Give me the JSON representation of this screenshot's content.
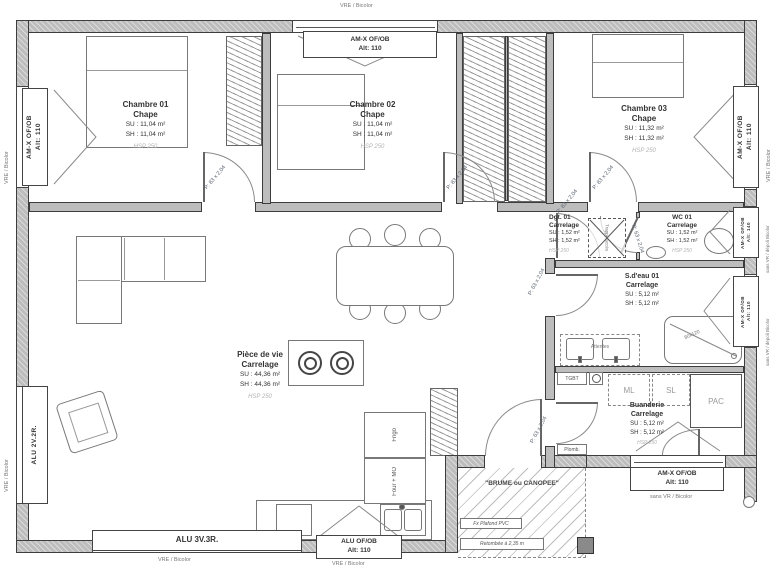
{
  "rooms": {
    "chambre1": {
      "name": "Chambre 01",
      "floor": "Chape",
      "su": "SU : 11,04 m²",
      "sh": "SH : 11,04 m²",
      "hsp": "HSP 250"
    },
    "chambre2": {
      "name": "Chambre 02",
      "floor": "Chape",
      "su": "SU : 11,04 m²",
      "sh": "SH : 11,04 m²",
      "hsp": "HSP 250"
    },
    "chambre3": {
      "name": "Chambre 03",
      "floor": "Chape",
      "su": "SU : 11,32 m²",
      "sh": "SH : 11,32 m²",
      "hsp": "HSP 250"
    },
    "degagement": {
      "name": "Dgt. 01",
      "floor": "Carrelage",
      "su": "SU : 1,52 m²",
      "sh": "SH : 1,52 m²",
      "hsp": "HSP 250"
    },
    "wc": {
      "name": "WC 01",
      "floor": "Carrelage",
      "su": "SU : 1,52 m²",
      "sh": "SH : 1,52 m²",
      "hsp": "HSP 250"
    },
    "salle_eau": {
      "name": "S.d'eau 01",
      "floor": "Carrelage",
      "su": "SU : 5,12 m²",
      "sh": "SH : 5,12 m²"
    },
    "buanderie": {
      "name": "Buanderie",
      "floor": "Carrelage",
      "su": "SU : 5,12 m²",
      "sh": "SH : 5,12 m²",
      "hsp": "HSP 250"
    },
    "piece_de_vie": {
      "name": "Pièce de vie",
      "floor": "Carrelage",
      "su": "SU : 44,36 m²",
      "sh": "SH : 44,36 m²",
      "hsp": "HSP 250"
    }
  },
  "openings": {
    "top_ch2": {
      "l1": "AM-X OF/OB",
      "l2": "Alt: 110",
      "out": "VRE / Bicolor"
    },
    "left_ch1": {
      "l1": "AM-X OF/OB",
      "l2": "Alt: 110",
      "out": "VRE / Bicolor"
    },
    "left_living": {
      "l1": "ALU 2V.2R.",
      "out": "VRE / Bicolor"
    },
    "right_ch3": {
      "l1": "AM-X OF/OB",
      "l2": "Alt: 110",
      "out": "VRE / Bicolor"
    },
    "right_wc": {
      "l1": "AM-X OF/OB",
      "l2": "Alt: 140",
      "out": "sans VR / dépoli Bicolor"
    },
    "right_sdeau": {
      "l1": "AM-X OF/OB",
      "l2": "Alt: 110",
      "out": "sans VR / dépoli Bicolor"
    },
    "bottom_bay": {
      "l1": "ALU 3V.3R.",
      "out": "VRE / Bicolor"
    },
    "bottom_kitchen": {
      "l1": "ALU OF/OB",
      "l2": "Alt: 110",
      "out": "VRE / Bicolor"
    },
    "bottom_buanderie": {
      "l1": "AM-X OF/OB",
      "l2": "Alt: 110",
      "out": "sans VR / Bicolor"
    }
  },
  "doors": {
    "p83": "P: 83 x 2,04",
    "p63": "P: 63 x 2,04"
  },
  "fixtures": {
    "tgbt": "TGBT",
    "ml": "ML",
    "sl": "SL",
    "pac": "PAC",
    "plomb": "Plomb.",
    "frigo": "Frigo",
    "four_mo": "Four + MO",
    "attentes": "Attentes",
    "shower_size": "80x120",
    "trappe": "Trappe accès"
  },
  "porch": {
    "title": "\"BRUME ou CANOPEE\"",
    "ceiling": "Fx Plafond PVC",
    "note": "Retombée à 2,35 m"
  }
}
